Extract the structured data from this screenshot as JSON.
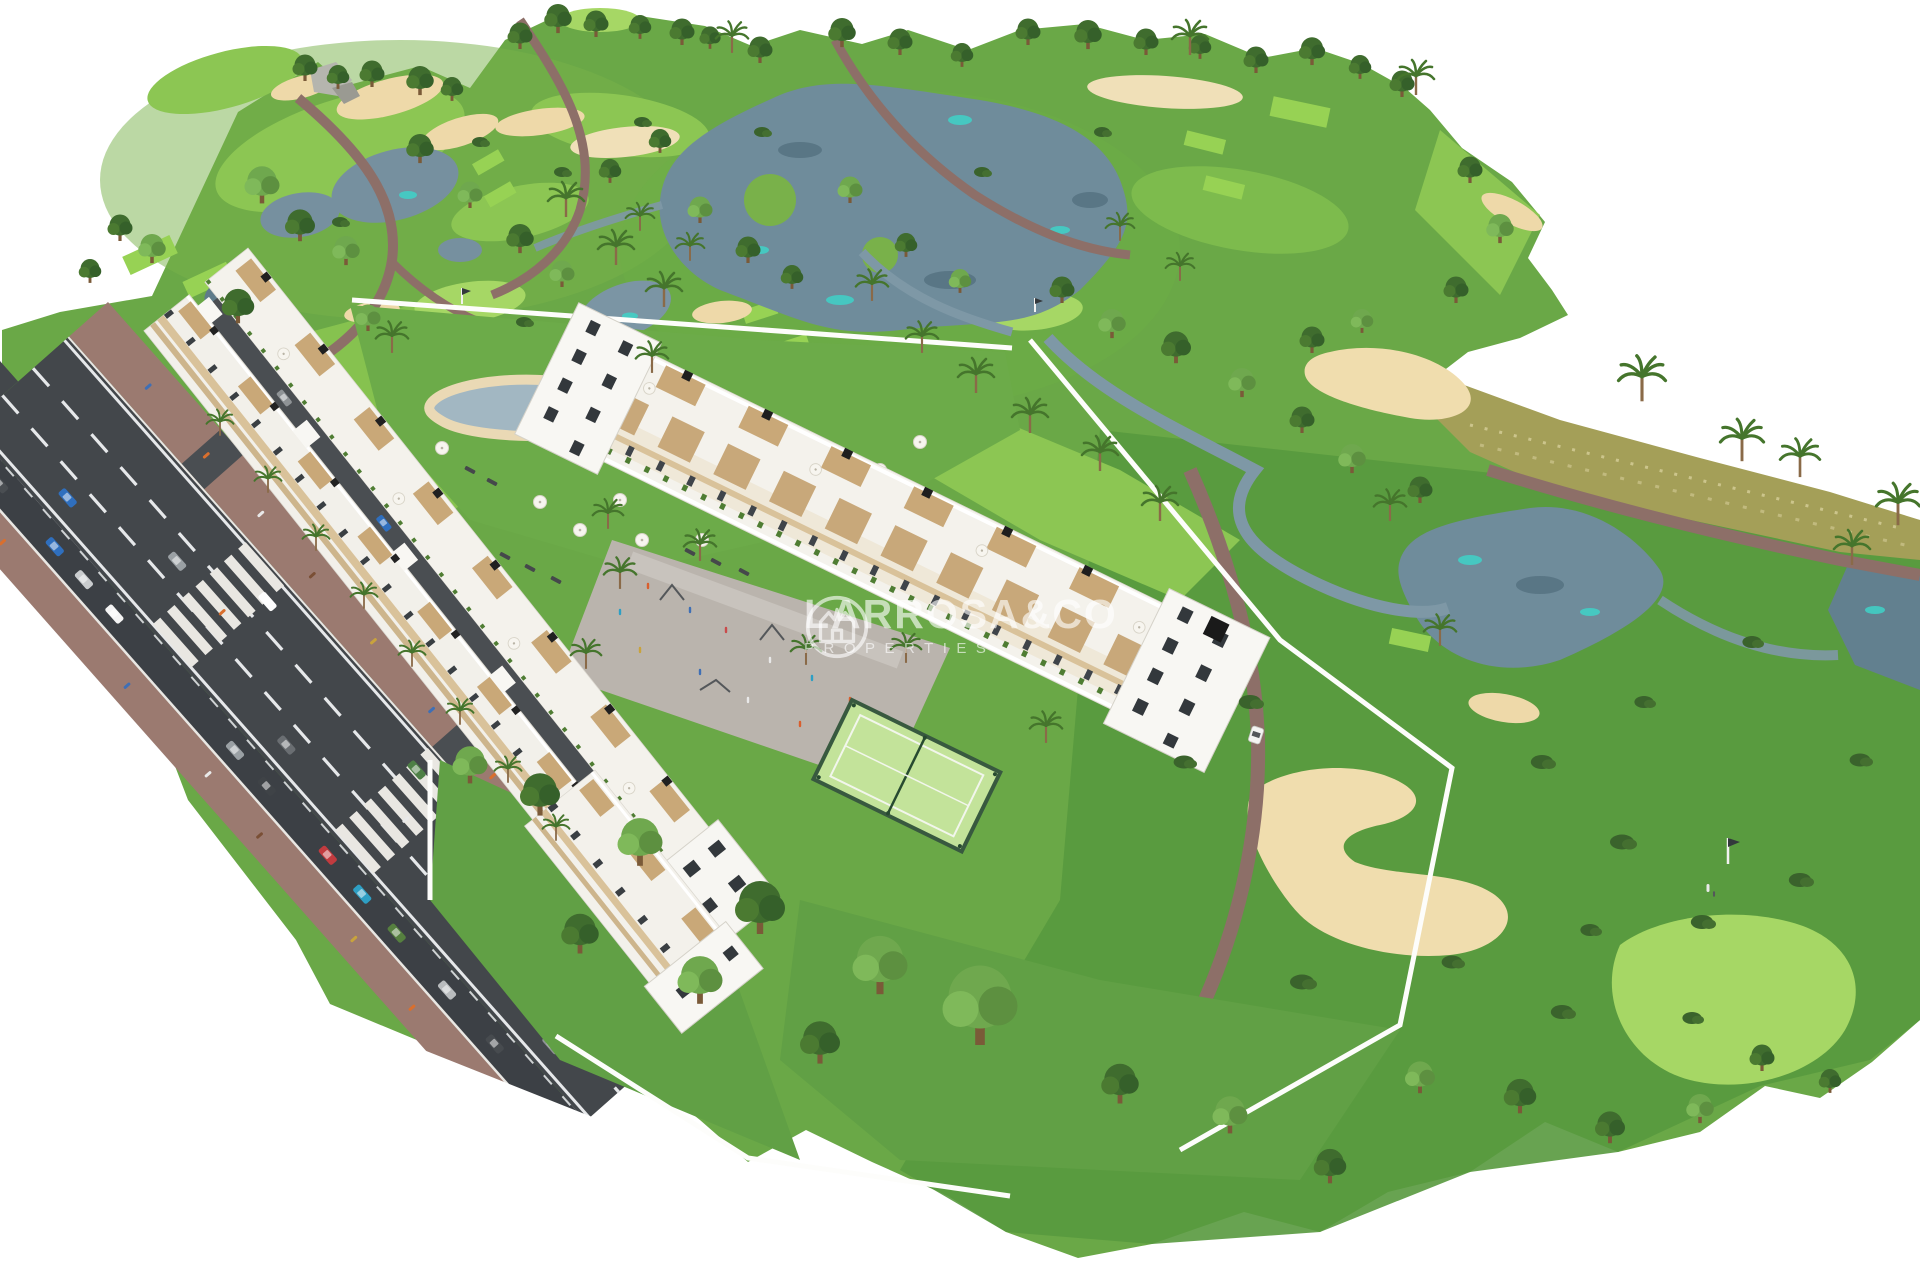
{
  "watermark": {
    "brand": "LARROSA&CO",
    "subtitle": "PROPERTIES",
    "logo_icon": "house-crown-circle-logo",
    "color": "#ffffff",
    "opacity": 0.62
  },
  "scene": {
    "type": "aerial-3d-architectural-render",
    "subject": "white apartment complex with rooftop terraces beside a golf course, avenue with traffic, pool, playground and paddle court",
    "palette": {
      "background": "#ffffff",
      "rough_green": "#6aa847",
      "deep_green": "#58993e",
      "fairway_green": "#8cc653",
      "putting_green": "#a6d765",
      "tee_green": "#97d254",
      "sand": "#eed9a9",
      "lake": "#6f8c9b",
      "lake_teal": "#3fd2c8",
      "path_mauve": "#8d6f68",
      "road_asphalt": "#43474b",
      "sidewalk": "#9b7a70",
      "building_white": "#f4f2ec",
      "balcony_beige": "#d9c29a",
      "pergola_tan": "#c9a878",
      "pool_water": "#a2b7c2",
      "court_green": "#c3e39a",
      "tree_dark": "#3f6c2e",
      "palm_green": "#45752c",
      "scrub": "#a49f58"
    }
  }
}
